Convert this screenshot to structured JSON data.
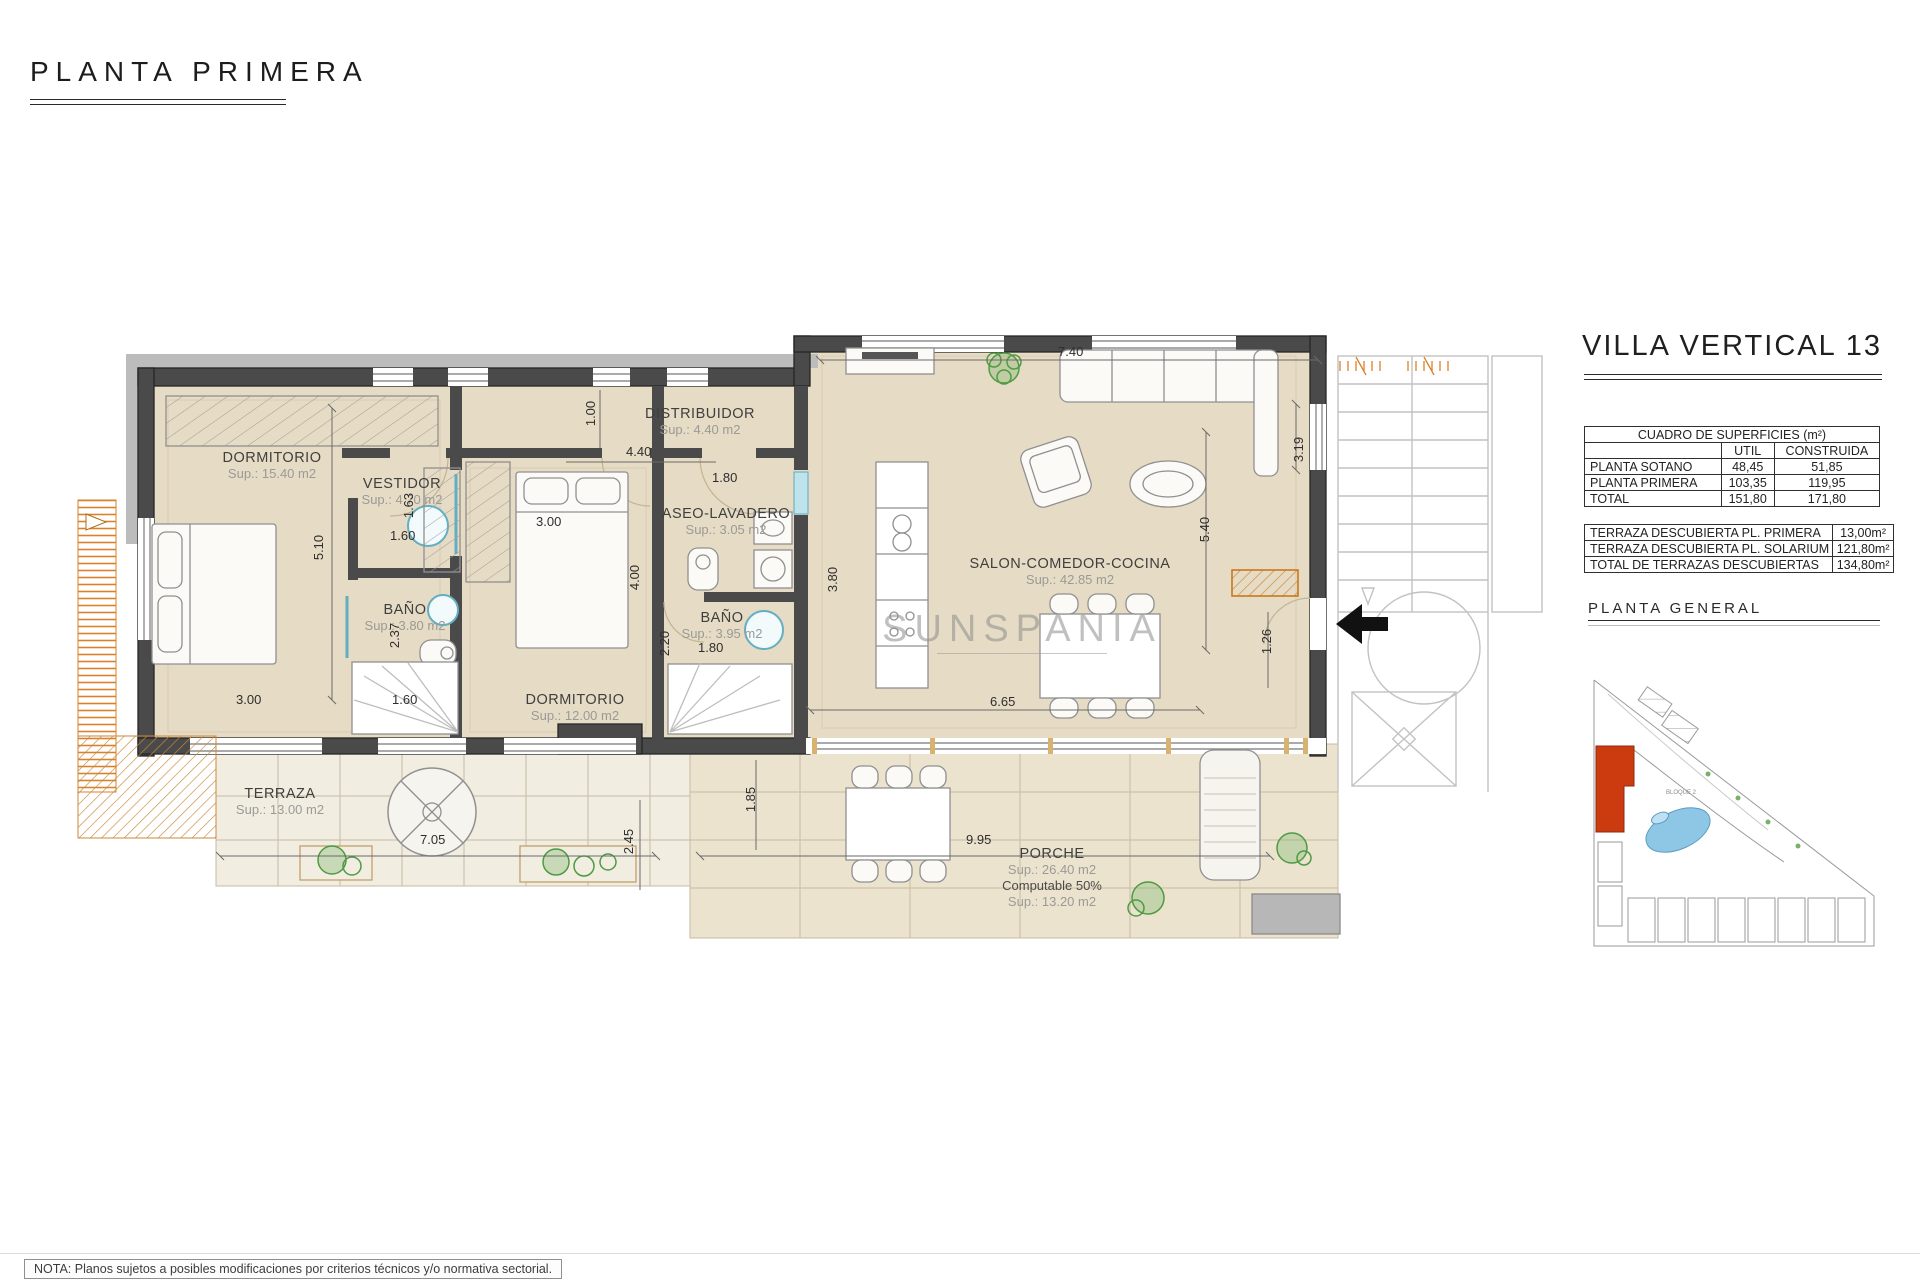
{
  "header": {
    "page_title": "PLANTA PRIMERA"
  },
  "watermark": {
    "text": "SUNSPANIA"
  },
  "side_panel": {
    "villa_title": "VILLA VERTICAL 13",
    "surface_table": {
      "title": "CUADRO DE SUPERFICIES (m²)",
      "col_util": "UTIL",
      "col_construida": "CONSTRUIDA",
      "rows": [
        {
          "label": "PLANTA SOTANO",
          "util": "48,45",
          "construida": "51,85"
        },
        {
          "label": "PLANTA PRIMERA",
          "util": "103,35",
          "construida": "119,95"
        },
        {
          "label": "TOTAL",
          "util": "151,80",
          "construida": "171,80"
        }
      ]
    },
    "terrace_table": {
      "rows": [
        {
          "label": "TERRAZA DESCUBIERTA PL. PRIMERA",
          "value": "13,00m²"
        },
        {
          "label": "TERRAZA DESCUBIERTA PL. SOLARIUM",
          "value": "121,80m²"
        },
        {
          "label": "TOTAL DE TERRAZAS DESCUBIERTAS",
          "value": "134,80m²"
        }
      ]
    },
    "site_plan_title": "PLANTA GENERAL",
    "site_plan_label": "BLOQUE 2"
  },
  "floor_plan": {
    "rooms": [
      {
        "name": "DORMITORIO",
        "sup": "Sup.: 15.40 m2"
      },
      {
        "name": "VESTIDOR",
        "sup": "Sup.: 4.70 m2"
      },
      {
        "name": "BAÑO",
        "sup": "Sup.: 3.80 m2"
      },
      {
        "name": "DORMITORIO",
        "sup": "Sup.: 12.00 m2"
      },
      {
        "name": "DISTRIBUIDOR",
        "sup": "Sup.: 4.40 m2"
      },
      {
        "name": "ASEO-LAVADERO",
        "sup": "Sup.: 3.05 m2"
      },
      {
        "name": "BAÑO",
        "sup": "Sup.: 3.95 m2"
      },
      {
        "name": "SALON-COMEDOR-COCINA",
        "sup": "Sup.: 42.85 m2"
      },
      {
        "name": "TERRAZA",
        "sup": "Sup.: 13.00 m2"
      },
      {
        "name": "PORCHE",
        "sup": "Sup.: 26.40 m2",
        "note": "Computable 50%",
        "sup2": "Sup.: 13.20 m2"
      }
    ],
    "dims": [
      "7.40",
      "3.19",
      "5.40",
      "1.26",
      "6.65",
      "1.00",
      "4.40",
      "1.80",
      "3.00",
      "1.63",
      "1.60",
      "5.10",
      "3.00",
      "1.60",
      "2.37",
      "2.20",
      "1.80",
      "4.00",
      "3.80",
      "7.05",
      "1.85",
      "2.45",
      "9.95"
    ]
  },
  "footer": {
    "note": "NOTA: Planos sujetos a posibles modificaciones por criterios técnicos y/o normativa sectorial."
  },
  "colors": {
    "accent_orange": "#d9822b",
    "wall_dark": "#4a4a4a",
    "floor_beige": "#e6dbc4",
    "fixture_teal": "#63aec2",
    "site_red": "#cc3a10",
    "pool_blue": "#8ec6e6"
  }
}
